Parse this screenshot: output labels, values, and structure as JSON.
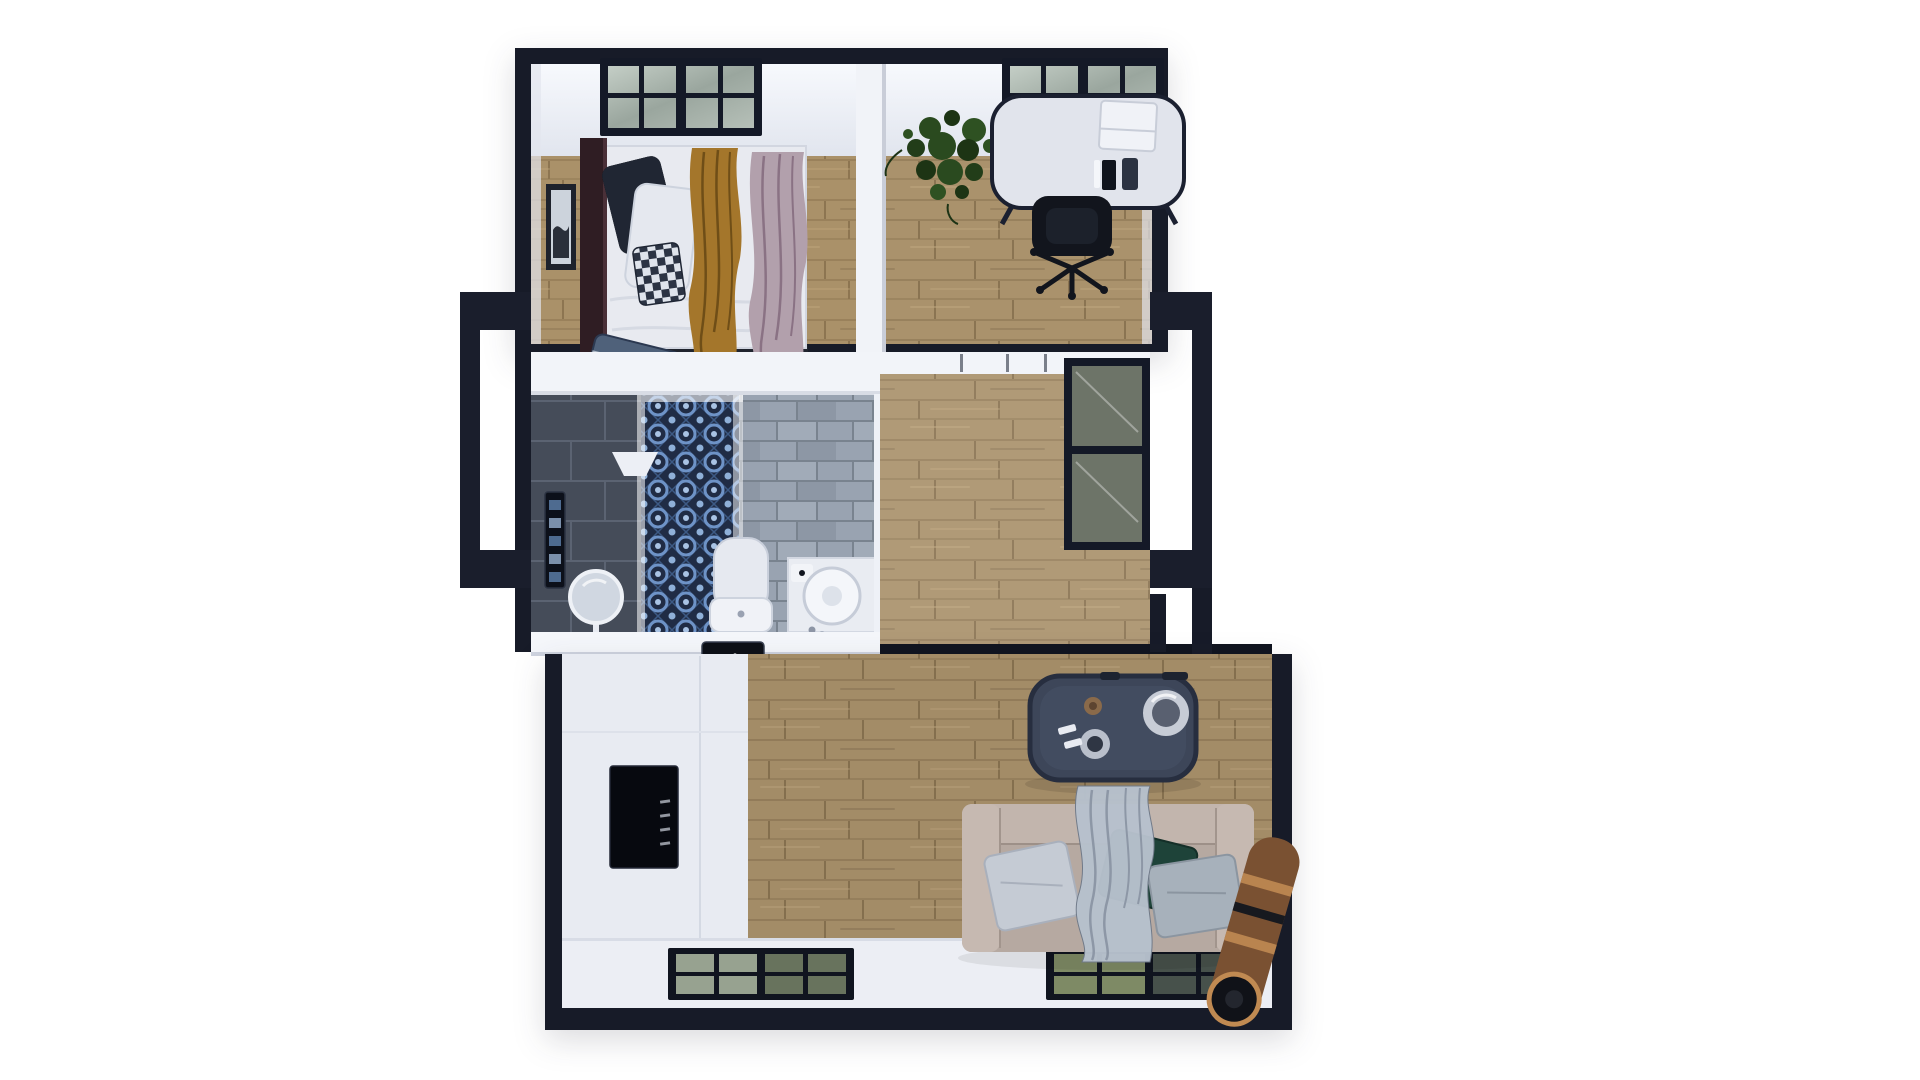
{
  "scene": {
    "type": "3D top-down floor plan rendering of an expandable container home",
    "background_color": "#ffffff",
    "label": "Top-down 3D floor plan"
  },
  "palette": {
    "wall_dark": "#171b28",
    "wall_white": "#f2f4f9",
    "wood_floor": "#aa926c",
    "mosaic_blue": "#6e93c7",
    "brick_grey": "#99a3b1",
    "tile_dark": "#454c59",
    "sofa_beige": "#b6a9a1",
    "table_navy": "#3d4659",
    "pillow_green": "#1e4339",
    "cloth_mustard": "#a4762b",
    "cloth_mauve": "#b2a0ac",
    "rug_copper": "#7a5132",
    "glass_olive": "#6d7468"
  },
  "rooms": [
    {
      "label": "Bedroom",
      "items": [
        "double bed",
        "dark wood headboard",
        "navy pillow",
        "white pillow",
        "checkered pillow",
        "mustard throw",
        "mauve throw",
        "blue folded blanket",
        "wall art",
        "black grid window"
      ]
    },
    {
      "label": "Home office",
      "items": [
        "white oval desk",
        "laptop",
        "desk accessories",
        "black office chair",
        "potted plant",
        "black grid window"
      ]
    },
    {
      "label": "Bathroom",
      "items": [
        "walk-in shower",
        "blue mosaic tile wall",
        "glass partition",
        "rain shower head",
        "shower control panel",
        "dark tile wall",
        "grey stone brick wall",
        "round vanity mirror",
        "toilet",
        "round basin on vanity",
        "soap tray"
      ]
    },
    {
      "label": "Kitchenette",
      "items": [
        "white counter",
        "dark cooktop panel",
        "built-in black oven"
      ]
    },
    {
      "label": "Hallway",
      "items": [
        "sliding door track",
        "open side door left",
        "glass balcony door right",
        "module junction seam"
      ]
    },
    {
      "label": "Living room",
      "items": [
        "navy coffee table",
        "chrome kettle and cups",
        "beige sofa",
        "light grey cushion",
        "green cushion",
        "grey cushion",
        "draped grey blanket",
        "rolled copper rug",
        "two floor grid windows"
      ]
    }
  ]
}
